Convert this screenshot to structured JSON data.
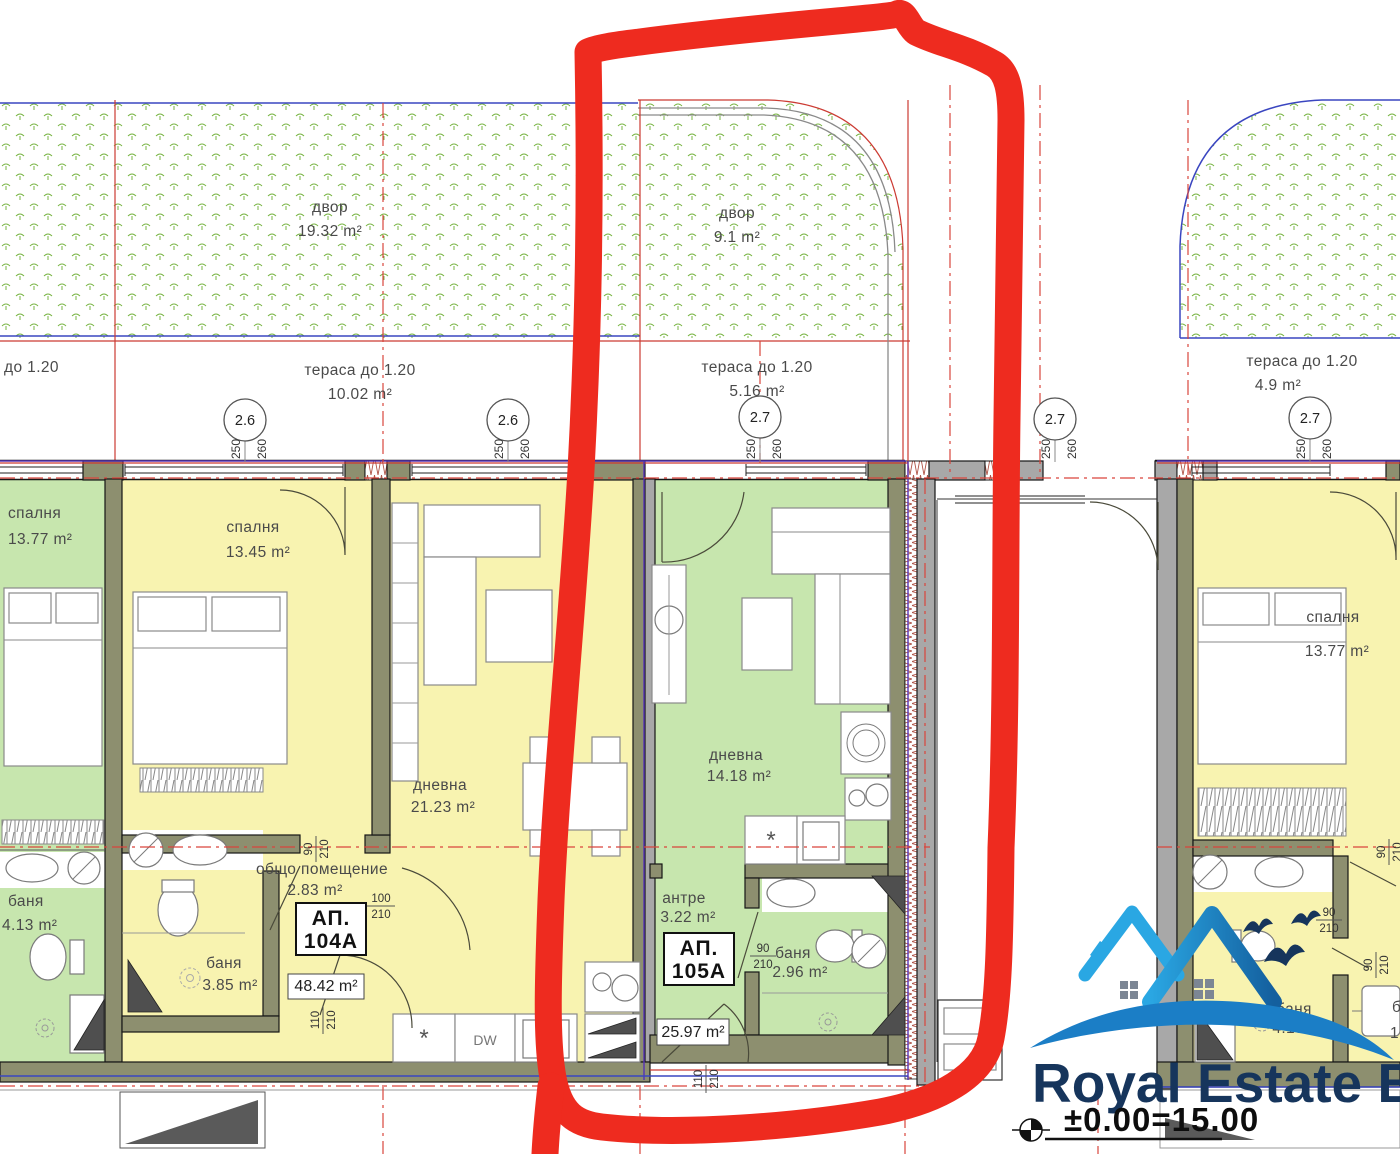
{
  "site": {
    "garden1": {
      "name": "двор",
      "area": "19.32 m²"
    },
    "garden2": {
      "name": "двор",
      "area": "9.1 m²"
    },
    "terrace_partial": "до 1.20",
    "terrace1": {
      "name": "тераса до 1.20",
      "area": "10.02 m²"
    },
    "terrace2": {
      "name": "тераса до 1.20",
      "area": "5.16 m²"
    },
    "terrace3": {
      "name": "тераса до 1.20",
      "area": "4.9 m²"
    }
  },
  "grid": {
    "bubbles": [
      "2.6",
      "2.6",
      "2.7",
      "2.7",
      "2.7"
    ],
    "d250": "250",
    "d260": "260"
  },
  "rooms": {
    "bedroom_green": {
      "name": "спалня",
      "area": "13.77 m²"
    },
    "bath_green": {
      "name": "баня",
      "area": "4.13 m²"
    },
    "bedroom_104": {
      "name": "спалня",
      "area": "13.45 m²"
    },
    "living_104": {
      "name": "дневна",
      "area": "21.23 m²"
    },
    "common_104": {
      "name": "общо помещение",
      "area": "2.83 m²"
    },
    "bath_104": {
      "name": "баня",
      "area": "3.85 m²"
    },
    "living_105": {
      "name": "дневна",
      "area": "14.18 m²"
    },
    "hall_105": {
      "name": "антре",
      "area": "3.22 m²"
    },
    "bath_105": {
      "name": "баня",
      "area": "2.96 m²"
    },
    "bedroom_right": {
      "name": "спалня",
      "area": "13.77 m²"
    },
    "bath_right": {
      "name": "баня",
      "area": "4.13 m²"
    },
    "partial_right": {
      "name": "б",
      "area": "1"
    }
  },
  "apartments": {
    "a104": {
      "label": "АП.",
      "number": "104А",
      "total": "48.42 m²"
    },
    "a105": {
      "label": "АП.",
      "number": "105А",
      "total": "25.97 m²"
    }
  },
  "kitchen": {
    "star": "*",
    "dw": "DW"
  },
  "dims": {
    "w90": "90",
    "w100": "100",
    "w110": "110",
    "h210": "210"
  },
  "logo": {
    "brand": "Royal Estate BG",
    "level": "±0.00=15.00"
  }
}
